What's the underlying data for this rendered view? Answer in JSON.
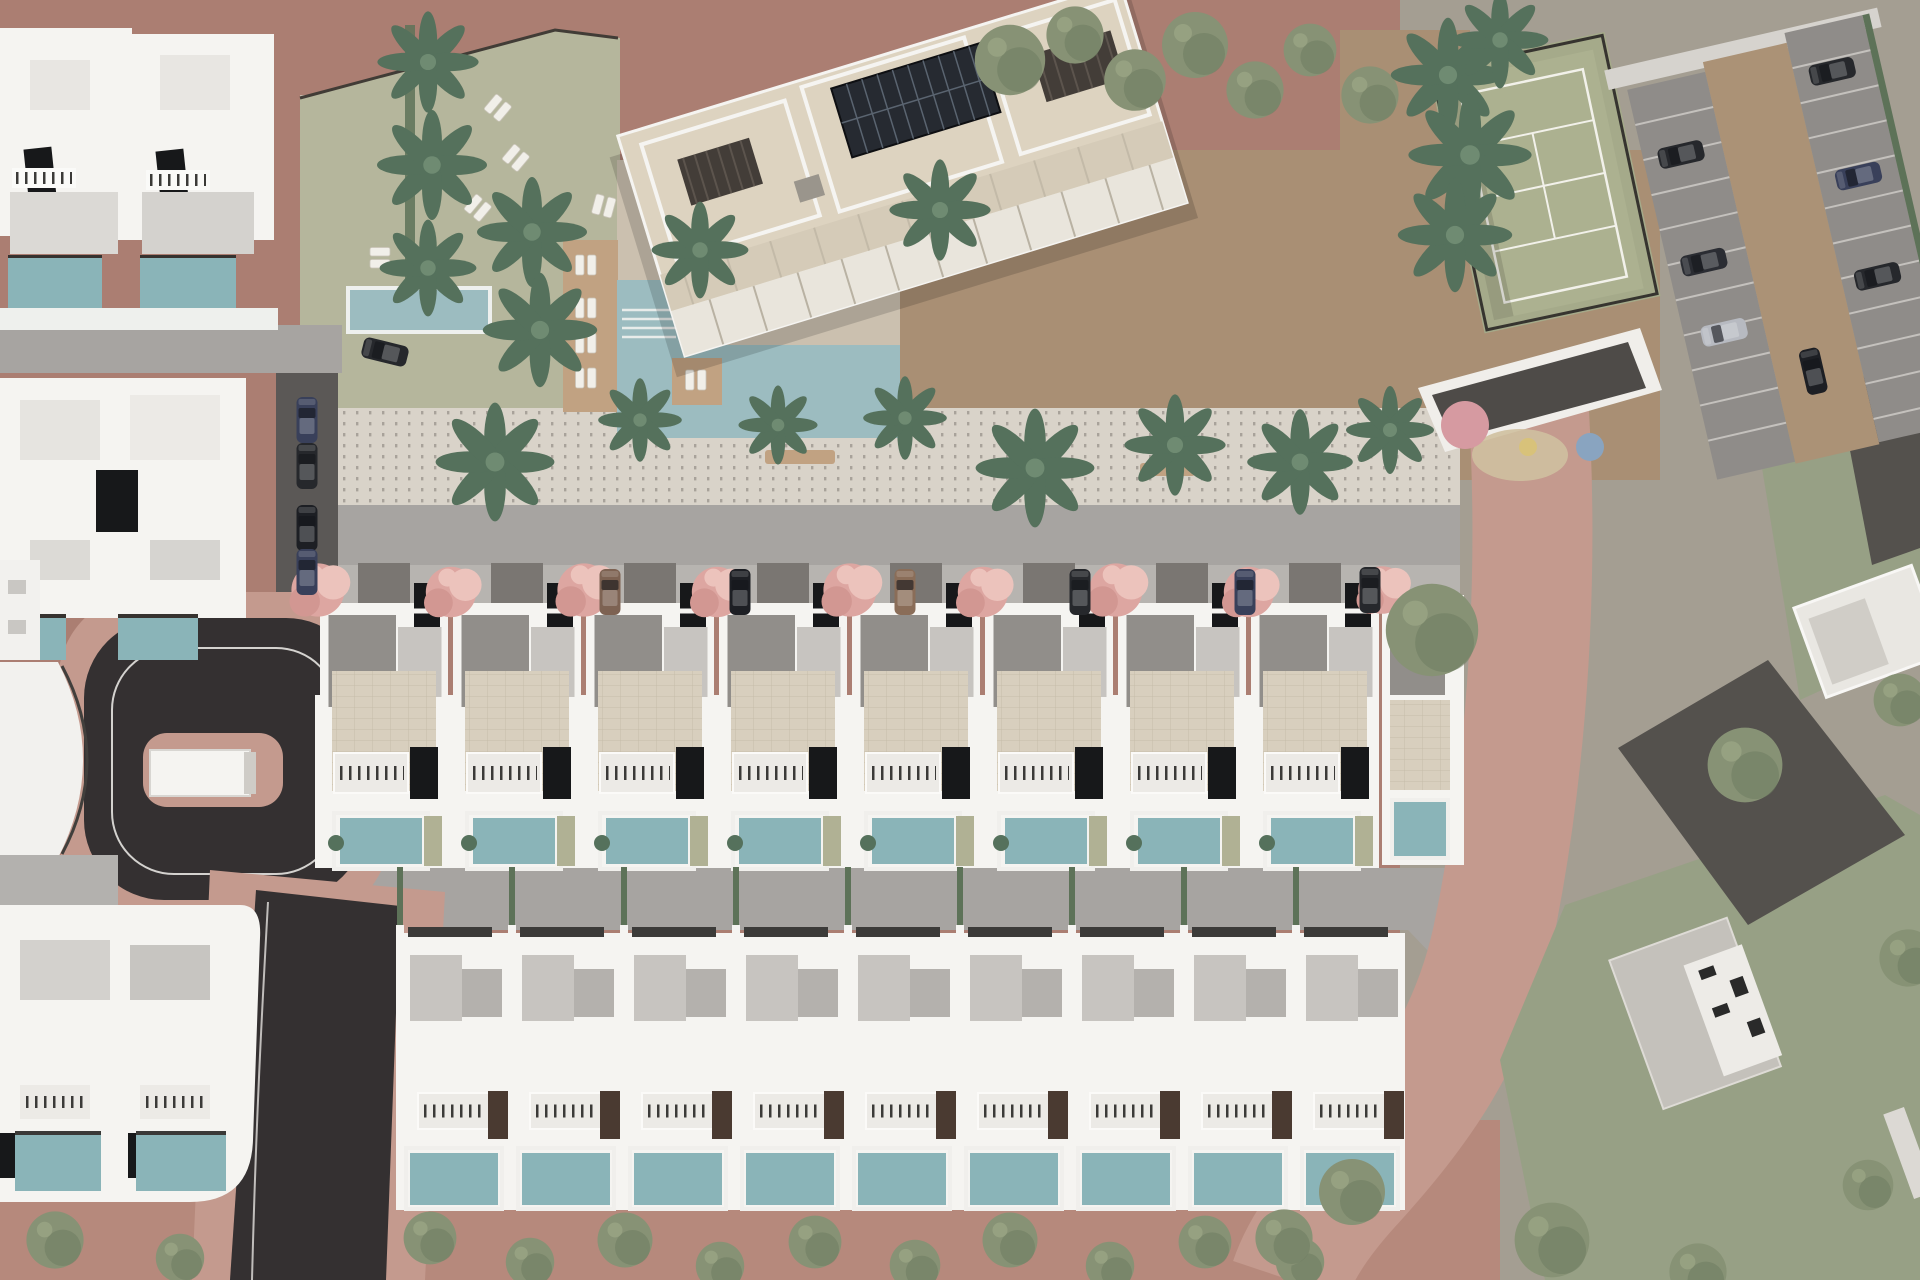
{
  "image": {
    "kind": "3d-aerial-architectural-site-plan-render",
    "orientation": "top-down",
    "width_px": 1920,
    "height_px": 1280
  },
  "palette": {
    "ground-mauve": "#ab7e72",
    "ground-pink": "#c49a8e",
    "ground-pink-deep": "#b6897c",
    "asphalt": "#343031",
    "road-gray": "#a7a4a1",
    "road-dark": "#5b5856",
    "sidewalk": "#b7b4b0",
    "promenade": "#d9d3c9",
    "promenade-dot": "#8d8781",
    "lawn": "#b5b69c",
    "dirt": "#a98f74",
    "gravel": "#c6b9ab",
    "deck": "#c1a282",
    "pool": "#9cbcc0",
    "pool-villa": "#8ab4b8",
    "white": "#f5f4f1",
    "white-soft": "#eceae6",
    "shadow-roof": "#918e8a",
    "roof-light": "#c7c4c0",
    "beige-roof": "#ddd3c0",
    "terrace-tile": "#d8cfbe",
    "solar": "#262a31",
    "panel-black": "#17181a",
    "pergola": "#433d38",
    "tennis": "#acb190",
    "line-white": "#f2f1ea",
    "fence": "#36342f",
    "palm": "#55715c",
    "palm-light": "#6f8b72",
    "olive": "#879275",
    "olive-dark": "#6d7b60",
    "pink-tree": "#dda6a1",
    "pink-tree-light": "#ecc3bc",
    "car-dark": "#26282c",
    "car-silver": "#b7bac1",
    "car-navy": "#39405a",
    "car-bronze": "#7d6252",
    "neighbor": "#a49e92",
    "neighbor-green": "#97a085",
    "neighbor-road": "#54514d",
    "pg-pink": "#d69aa1",
    "pg-blue": "#89a4c0",
    "pg-sand": "#cfc0a0",
    "stall": "#8f8c89",
    "hedge": "#5d7258"
  },
  "scene": {
    "apartment_building": {
      "count": 1,
      "rotation_deg": -17,
      "features": [
        "rooftop-solar-array",
        "dark-pergolas",
        "white-parapets",
        "terrace-rows"
      ]
    },
    "communal_area": {
      "main_pool": 1,
      "small_pool": 1,
      "wooden_deck": true,
      "sun_lounger_pairs": 10,
      "lawn": true
    },
    "tennis_court": {
      "count": 1,
      "surface_color": "#acb190",
      "line_color": "#f2f1ea",
      "fenced": true
    },
    "playground": {
      "circle_colors": [
        "#d69aa1",
        "#89a4c0",
        "#d8c27a"
      ]
    },
    "parking_lot": {
      "double_row": true,
      "cars": 7,
      "access_ramp": true
    },
    "townhouse_row_middle": {
      "units": 9,
      "private_pools": 9,
      "street_trees_pink": 9,
      "driveway_cars": 6
    },
    "villa_row_bottom": {
      "units": 9,
      "private_pools": 9
    },
    "existing_villas_left": {
      "clusters": 4,
      "pools": 8,
      "solar_panels": true
    },
    "roads": {
      "cul_de_sac_loop": 1,
      "asphalt_exit_road": 1,
      "gray_streets": 3,
      "pink_perimeter_road": 1
    },
    "vegetation": {
      "palm_trees": 20,
      "round_trees": 28,
      "pink_flowering_trees": 9
    }
  }
}
